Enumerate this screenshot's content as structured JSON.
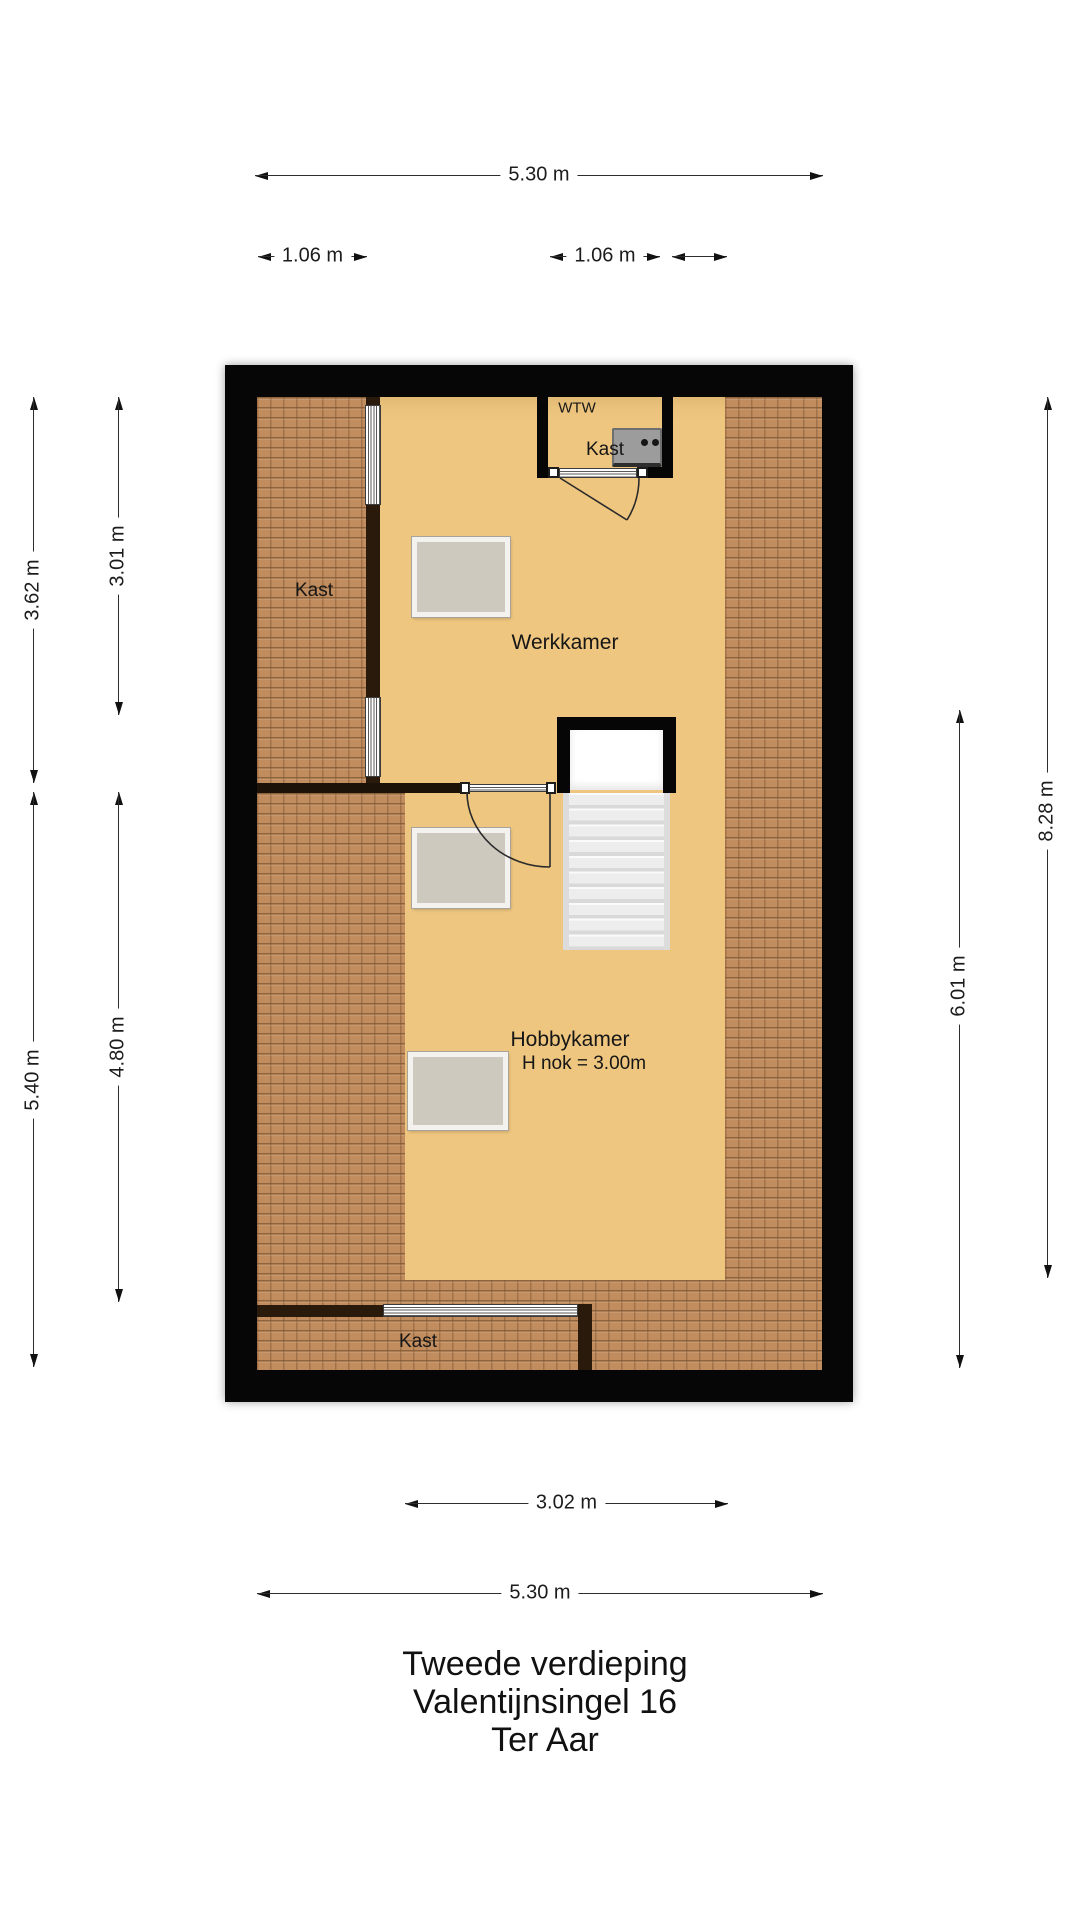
{
  "title": [
    "Tweede verdieping",
    "Valentijnsingel 16",
    "Ter Aar"
  ],
  "labels": {
    "werkkamer": "Werkkamer",
    "hobbykamer": "Hobbykamer",
    "hobbykamer_sub": "H nok = 3.00m",
    "kast_left": "Kast",
    "kast_top": "Kast",
    "kast_bottom": "Kast",
    "wtw": "WTW"
  },
  "dimensions": {
    "top_width": {
      "label": "5.30 m"
    },
    "top_left_segment": {
      "label": "1.06 m"
    },
    "top_right_segment": {
      "label": "1.06 m"
    },
    "top_unlabeled_segment": {
      "label": ""
    },
    "left_upper_outer": {
      "label": "3.62 m"
    },
    "left_upper_inner": {
      "label": "3.01 m"
    },
    "left_lower_outer": {
      "label": "5.40 m"
    },
    "left_lower_inner": {
      "label": "4.80 m"
    },
    "right_outer": {
      "label": "8.28 m"
    },
    "right_inner": {
      "label": "6.01 m"
    },
    "bottom_inner": {
      "label": "3.02 m"
    },
    "bottom_width": {
      "label": "5.30 m"
    }
  },
  "colors": {
    "wall": "#060606",
    "floor": "#eec67f",
    "roof_hatch": "#c18c5e",
    "inner_wall": "#2a1a0c",
    "desk": "#cdc9bf",
    "stairs": "#ededed",
    "wtw_unit": "#9c9c9c",
    "dimension": "#2d2d2d"
  }
}
